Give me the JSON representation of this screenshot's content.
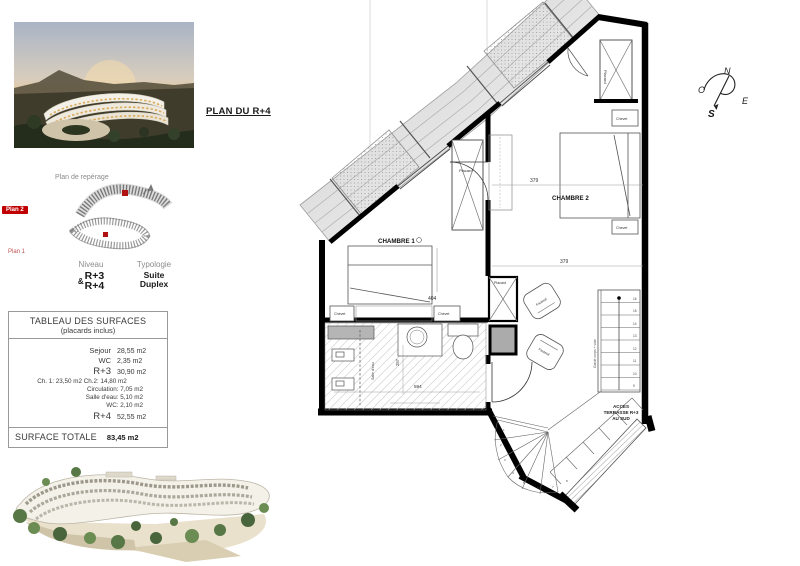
{
  "header": {
    "plan_title": "PLAN DU R+4"
  },
  "reperage": {
    "title": "Plan de repérage",
    "plan2": "Plan 2",
    "plan1": "Plan 1"
  },
  "unit_info": {
    "niveau_header": "Niveau",
    "typologie_header": "Typologie",
    "amp": "&",
    "level1": "R+3",
    "level2": "R+4",
    "typo1": "Suite",
    "typo2": "Duplex"
  },
  "surfaces": {
    "title": "TABLEAU DES SURFACES",
    "subtitle": "(placards inclus)",
    "rows": [
      {
        "label": "Sejour",
        "value": "28,55 m2"
      },
      {
        "label": "WC",
        "value": "2,35 m2"
      },
      {
        "label": "R+3",
        "value": "30,90 m2"
      }
    ],
    "detail_ch": "Ch. 1: 23,50 m2    Ch.2: 14,80 m2",
    "detail_circ": "Circulation: 7,05 m2",
    "detail_sde": "Salle d'eau: 5,10 m2",
    "detail_wc": "WC: 2,10 m2",
    "r4_label": "R+4",
    "r4_value": "52,55 m2",
    "total_label": "SURFACE TOTALE",
    "total_value": "83,45 m2"
  },
  "floorplan": {
    "room1": "CHAMBRE 1",
    "room2": "CHAMBRE 2",
    "placard": "Placard",
    "chevet": "Chevet",
    "fauteuil": "Fauteuil",
    "dim_404": "404",
    "dim_379": "379",
    "dim_594": "594",
    "dim_257": "257",
    "salle_eau": "Salle d'eau",
    "access_1": "ACCES",
    "access_2": "TERRASSE R+3",
    "access_3": "AU SUD",
    "stair_note": "Garde corps + vide",
    "stair_numbers": [
      "16",
      "15",
      "14",
      "13",
      "12",
      "11",
      "10",
      "9"
    ],
    "fan_numbers": [
      "1",
      "2",
      "3",
      "4",
      "5",
      "6",
      "7",
      "8"
    ]
  },
  "compass": {
    "n": "N",
    "s": "S",
    "e": "E",
    "o": "O"
  },
  "colors": {
    "wall": "#000000",
    "accent_red": "#c00000",
    "hatch": "#bbbbbb"
  }
}
